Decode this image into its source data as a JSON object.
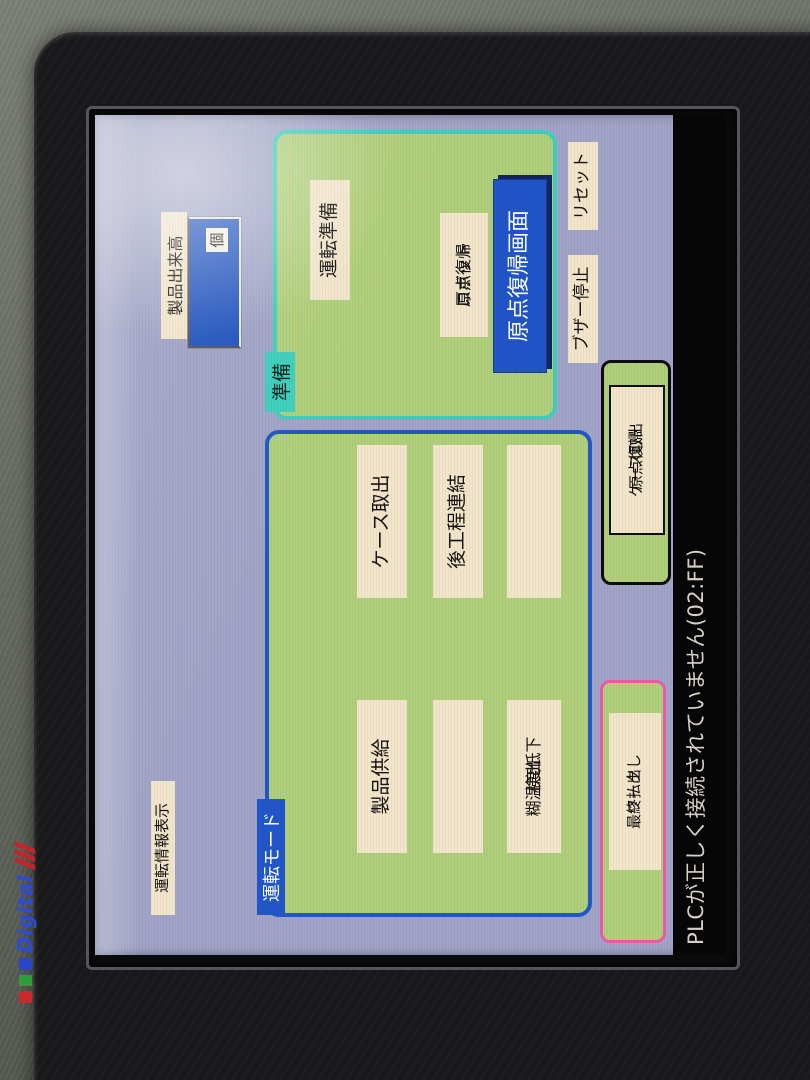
{
  "device": {
    "brand": "Digital",
    "status_message": "PLCが正しく接続されていません(02:FF)"
  },
  "screen": {
    "info_button_label": "運転情報表示",
    "production": {
      "label": "製品出来高",
      "value": "",
      "unit": "個"
    },
    "prepare_panel": {
      "tab": "準備",
      "run_prepare": "運転準備",
      "robot_home_line1": "ロボット",
      "robot_home_line2": "原点復帰",
      "home_screen": "原点復帰画面"
    },
    "buzzer_stop": "ブザー停止",
    "reset": "リセット",
    "mode_panel": {
      "tab": "運転モード",
      "buttons": [
        {
          "line1": "製品供給",
          "line2": ""
        },
        {
          "line1": "ケース取出",
          "line2": ""
        },
        {
          "line1": "",
          "line2": ""
        },
        {
          "line1": "後工程連結",
          "line2": ""
        },
        {
          "line1": "糊温度低下",
          "line2": "検出"
        },
        {
          "line1": "",
          "line2": ""
        }
      ]
    },
    "work_panel": {
      "button_line1": "ワーク",
      "button_line2": "最終払出し"
    },
    "case_home_panel": {
      "button_line1": "ケース取出",
      "button_line2": "原点復帰"
    }
  },
  "colors": {
    "screen_bg": "#a1a4c6",
    "panel_green": "#b0cf7b",
    "border_cyan": "#3ecfbc",
    "border_blue": "#2257c9",
    "border_pink": "#ee59ac",
    "button_cream": "#f2e5ca",
    "accent_blue": "#2154c6",
    "status_bg": "#060606"
  }
}
